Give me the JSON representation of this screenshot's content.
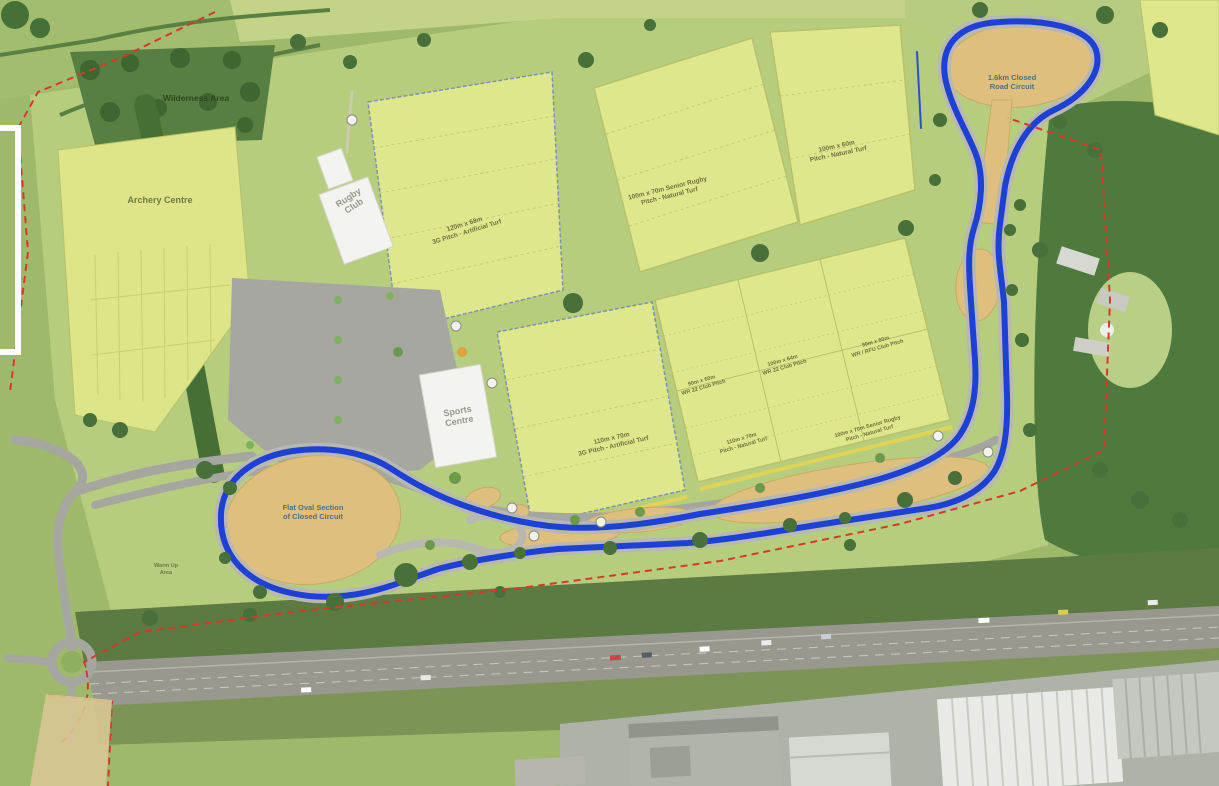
{
  "site": {
    "title": "Sports campus aerial masterplan",
    "areas": {
      "archery": {
        "label": "Archery Centre"
      },
      "wilderness": {
        "label": "Wilderness Area"
      },
      "warm_up": {
        "label_line1": "Warm Up",
        "label_line2": "Area"
      }
    },
    "buildings": {
      "rugby_club": {
        "name_line1": "Rugby",
        "name_line2": "Club"
      },
      "sports_centre": {
        "name_line1": "Sports",
        "name_line2": "Centre"
      }
    },
    "pitches": [
      {
        "id": "north-3g",
        "dims": "120m x 68m",
        "desc": "3G Pitch - Artificial Turf"
      },
      {
        "id": "north-central",
        "dims": "100m x 70m Senior Rugby",
        "desc": "Pitch - Natural Turf"
      },
      {
        "id": "north-east",
        "dims": "100m x 60m",
        "desc": "Pitch - Natural Turf"
      },
      {
        "id": "central-3g",
        "dims": "110m x 70m",
        "desc": "3G Pitch - Artificial Turf"
      },
      {
        "id": "cluster-a",
        "dims": "90m x 60m",
        "desc": "WR 22 Club Pitch"
      },
      {
        "id": "cluster-b",
        "dims": "100m x 64m",
        "desc": "WR 22 Club Pitch"
      },
      {
        "id": "cluster-c",
        "dims": "90m x 60m",
        "desc": "WR / RFU Club Pitch"
      },
      {
        "id": "cluster-d",
        "dims": "110m x 70m",
        "desc": "Pitch - Natural Turf"
      },
      {
        "id": "cluster-e",
        "dims": "100m x 70m Senior Rugby",
        "desc": "Pitch - Natural Turf"
      }
    ],
    "circuit": {
      "name_line1": "1.6km Closed",
      "name_line2": "Road Circuit",
      "oval_line1": "Flat Oval Section",
      "oval_line2": "of Closed Circuit",
      "line_color": "#1c41d4"
    },
    "colors": {
      "boundary_red": "#d6392c",
      "circuit_blue": "#1c41d4",
      "pitch_green": "#dfe78d",
      "campus_green": "#b6cd7e",
      "woodland_green": "#4f7a3e",
      "dirt_tan": "#debf7d",
      "road_grey": "#a6a6a0",
      "building_white": "#f3f3ef"
    }
  }
}
